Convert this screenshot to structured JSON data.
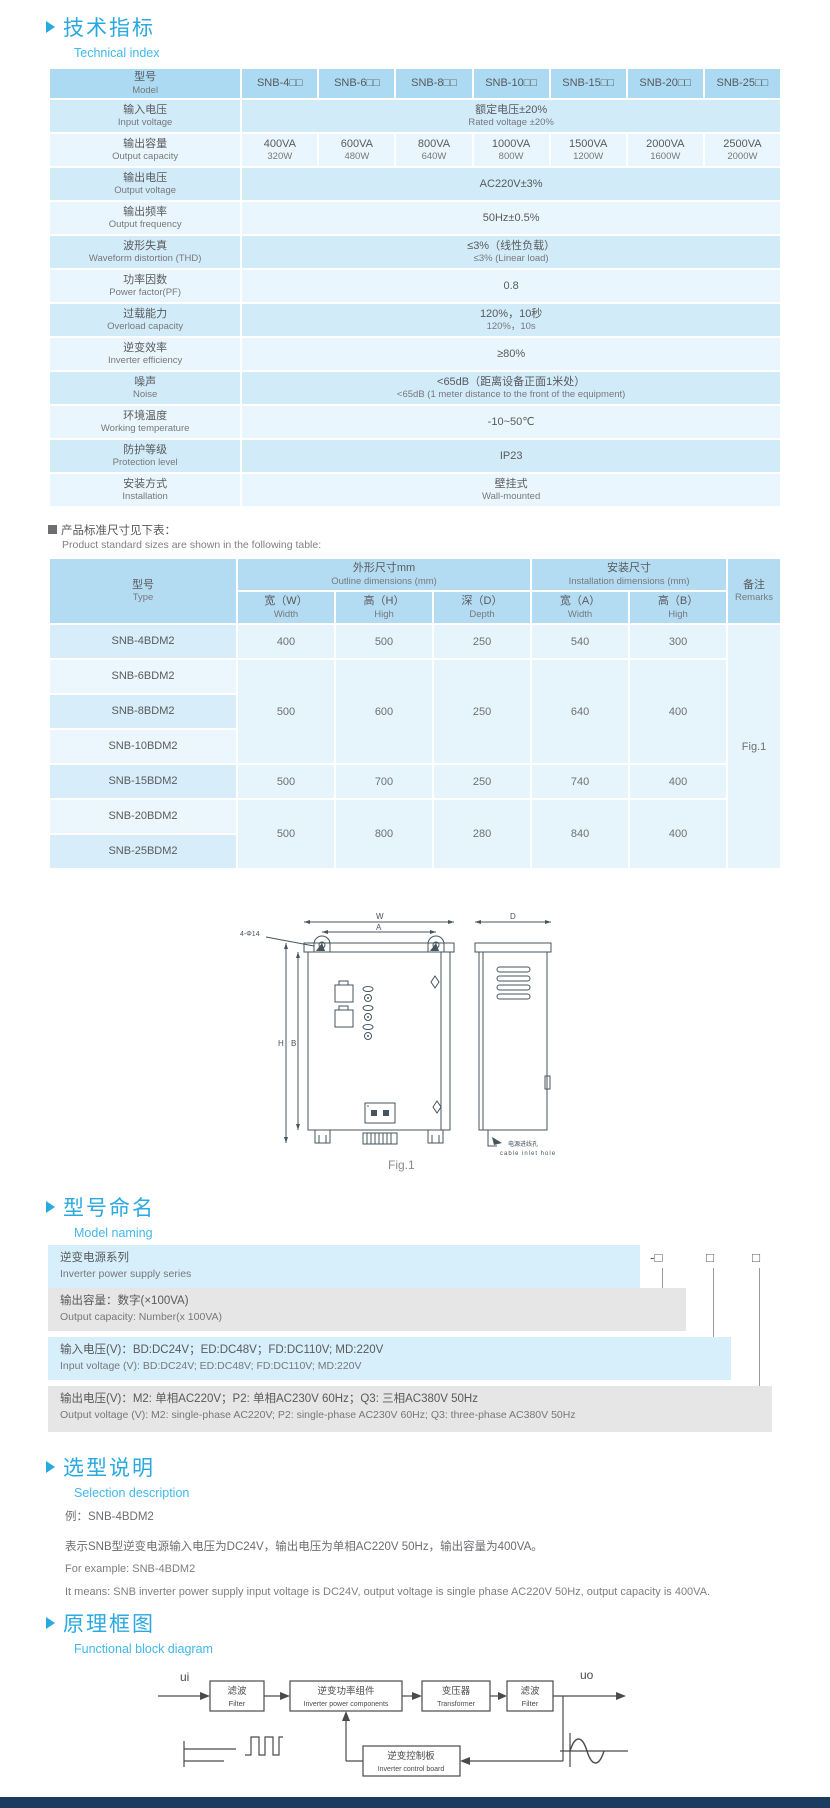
{
  "tech": {
    "title_zh": "技术指标",
    "title_en": "Technical index"
  },
  "spec_table": {
    "model_header": {
      "zh": "型号",
      "en": "Model"
    },
    "models": [
      "SNB-4□□",
      "SNB-6□□",
      "SNB-8□□",
      "SNB-10□□",
      "SNB-15□□",
      "SNB-20□□",
      "SNB-25□□"
    ],
    "rows": [
      {
        "zh": "输入电压",
        "en": "Input voltage",
        "value": [
          "额定电压±20%",
          "Rated voltage ±20%"
        ]
      },
      {
        "zh": "输出容量",
        "en": "Output capacity",
        "cells": [
          [
            "400VA",
            "320W"
          ],
          [
            "600VA",
            "480W"
          ],
          [
            "800VA",
            "640W"
          ],
          [
            "1000VA",
            "800W"
          ],
          [
            "1500VA",
            "1200W"
          ],
          [
            "2000VA",
            "1600W"
          ],
          [
            "2500VA",
            "2000W"
          ]
        ]
      },
      {
        "zh": "输出电压",
        "en": "Output voltage",
        "value": [
          "AC220V±3%"
        ]
      },
      {
        "zh": "输出频率",
        "en": "Output frequency",
        "value": [
          "50Hz±0.5%"
        ]
      },
      {
        "zh": "波形失真",
        "en": "Waveform distortion (THD)",
        "value": [
          "≤3%（线性负载）",
          "≤3% (Linear load)"
        ]
      },
      {
        "zh": "功率因数",
        "en": "Power factor(PF)",
        "value": [
          "0.8"
        ]
      },
      {
        "zh": "过载能力",
        "en": "Overload capacity",
        "value": [
          "120%，10秒",
          "120%，10s"
        ]
      },
      {
        "zh": "逆变效率",
        "en": "Inverter efficiency",
        "value": [
          "≥80%"
        ]
      },
      {
        "zh": "噪声",
        "en": "Noise",
        "value": [
          "<65dB（距离设备正面1米处）",
          "<65dB (1 meter distance to the front of the equipment)"
        ]
      },
      {
        "zh": "环境温度",
        "en": "Working temperature",
        "value": [
          "-10~50℃"
        ]
      },
      {
        "zh": "防护等级",
        "en": "Protection level",
        "value": [
          "IP23"
        ]
      },
      {
        "zh": "安装方式",
        "en": "Installation",
        "value": [
          "壁挂式",
          "Wall-mounted"
        ]
      }
    ]
  },
  "size_note": {
    "zh": "产品标准尺寸见下表：",
    "en": "Product standard sizes are shown in the following table:"
  },
  "size_table": {
    "header": {
      "type_zh": "型号",
      "type_en": "Type",
      "outline_zh": "外形尺寸mm",
      "outline_en": "Outline dimensions (mm)",
      "install_zh": "安装尺寸",
      "install_en": "Installation dimensions (mm)",
      "remarks_zh": "备注",
      "remarks_en": "Remarks",
      "cols": [
        {
          "zh": "宽（W）",
          "en": "Width"
        },
        {
          "zh": "高（H）",
          "en": "High"
        },
        {
          "zh": "深（D）",
          "en": "Depth"
        },
        {
          "zh": "宽（A）",
          "en": "Width"
        },
        {
          "zh": "高（B）",
          "en": "High"
        }
      ]
    },
    "rows": [
      {
        "type": "SNB-4BDM2",
        "dims": [
          "400",
          "500",
          "250",
          "540",
          "300"
        ],
        "span": 1
      },
      {
        "type": "SNB-6BDM2",
        "dims": [
          "500",
          "600",
          "250",
          "640",
          "400"
        ],
        "span": 3
      },
      {
        "type": "SNB-8BDM2"
      },
      {
        "type": "SNB-10BDM2"
      },
      {
        "type": "SNB-15BDM2",
        "dims": [
          "500",
          "700",
          "250",
          "740",
          "400"
        ],
        "span": 1
      },
      {
        "type": "SNB-20BDM2",
        "dims": [
          "500",
          "800",
          "280",
          "840",
          "400"
        ],
        "span": 2
      },
      {
        "type": "SNB-25BDM2"
      }
    ],
    "remark": "Fig.1"
  },
  "figure": {
    "caption": "Fig.1",
    "dim_w": "W",
    "dim_a": "A",
    "dim_d": "D",
    "dim_h": "H",
    "dim_b": "B",
    "holes": "4-Φ14",
    "cable_zh": "电源进线孔",
    "cable_en": "cable inlet hole"
  },
  "naming": {
    "title_zh": "型号命名",
    "title_en": "Model naming",
    "code": [
      "SNB",
      "-□",
      "□",
      "□"
    ],
    "bars": [
      {
        "zh": "逆变电源系列",
        "en": "Inverter power supply series"
      },
      {
        "zh": "输出容量：数字(×100VA)",
        "en": "Output capacity: Number(x 100VA)"
      },
      {
        "zh": "输入电压(V)：BD:DC24V；ED:DC48V；FD:DC110V; MD:220V",
        "en": "Input voltage (V): BD:DC24V;  ED:DC48V;  FD:DC110V; MD:220V"
      },
      {
        "zh": "输出电压(V)：M2: 单相AC220V；P2: 单相AC230V 60Hz；Q3: 三相AC380V 50Hz",
        "en": "Output voltage (V):  M2: single-phase AC220V;  P2: single-phase AC230V 60Hz;  Q3: three-phase AC380V 50Hz"
      }
    ]
  },
  "selection": {
    "title_zh": "选型说明",
    "title_en": "Selection description",
    "example_zh": "例：SNB-4BDM2",
    "desc_zh": "表示SNB型逆变电源输入电压为DC24V，输出电压为单相AC220V 50Hz，输出容量为400VA。",
    "example_en": "For example: SNB-4BDM2",
    "desc_en": "It means: SNB inverter power supply input voltage is DC24V, output voltage is single phase AC220V 50Hz, output capacity is 400VA."
  },
  "diagram": {
    "title_zh": "原理框图",
    "title_en": "Functional block diagram",
    "input_label": "ui",
    "output_label": "uo",
    "blocks": [
      {
        "zh": "滤波",
        "en": "Filter"
      },
      {
        "zh": "逆变功率组件",
        "en": "Inverter power components"
      },
      {
        "zh": "变压器",
        "en": "Transformer"
      },
      {
        "zh": "滤波",
        "en": "Filter"
      }
    ],
    "feedback": {
      "zh": "逆变控制板",
      "en": "Inverter control board"
    }
  },
  "colors": {
    "accent": "#29a9e0",
    "table_header": "#abdaf2",
    "row_dark": "#d2ebf9",
    "row_light": "#eaf6fd",
    "blue_bar": "#d7effb",
    "gray_bar": "#e6e6e6",
    "footer": "#1c3b60"
  }
}
